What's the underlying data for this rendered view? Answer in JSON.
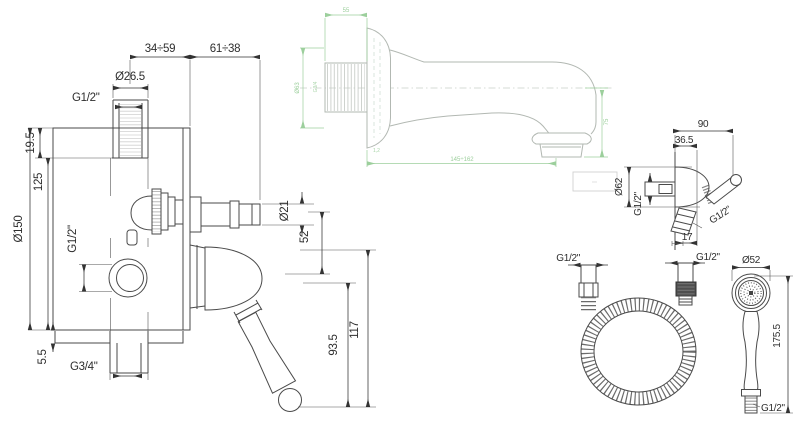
{
  "drawing": {
    "colors": {
      "line": "#4a4a4a",
      "dim_text": "#2e2e2e",
      "green": "#9ccf9c",
      "background": "#ffffff"
    },
    "mixer_view": {
      "dim_projection_a": "34÷59",
      "dim_projection_b": "61÷38",
      "dim_top_pipe_diameter": "Ø26.5",
      "dim_top_pipe_thread": "G1/2\"",
      "dim_top_offset": "19.5",
      "dim_plate_diameter": "Ø150",
      "dim_center_distance": "125",
      "dim_outlet_thread": "G1/2\"",
      "dim_bottom_gap": "5.5",
      "dim_bottom_pipe_thread": "G3/4\"",
      "dim_spout_pipe_diameter": "Ø21",
      "dim_axis_distance": "52",
      "dim_lever_length": "93.5",
      "dim_total_height": "117"
    },
    "spout_view": {
      "dim_thread_length": "55",
      "dim_flange_diameter": "Ø63",
      "dim_thread": "G3/4",
      "dim_gasket": "1,2",
      "dim_length": "145÷162",
      "dim_drop_height": "75"
    },
    "holder_view": {
      "dim_width": "90",
      "dim_depth": "36.5",
      "dim_body_diameter": "Ø62",
      "dim_wall_thread": "G1/2\"",
      "dim_outlet_thread": "G1/2\"",
      "dim_nipple_length": "17"
    },
    "hose_view": {
      "dim_left_thread": "G1/2\"",
      "dim_right_thread": "G1/2\""
    },
    "handshower_view": {
      "dim_head_diameter": "Ø52",
      "dim_length": "175.5",
      "dim_thread": "G1/2\""
    }
  }
}
